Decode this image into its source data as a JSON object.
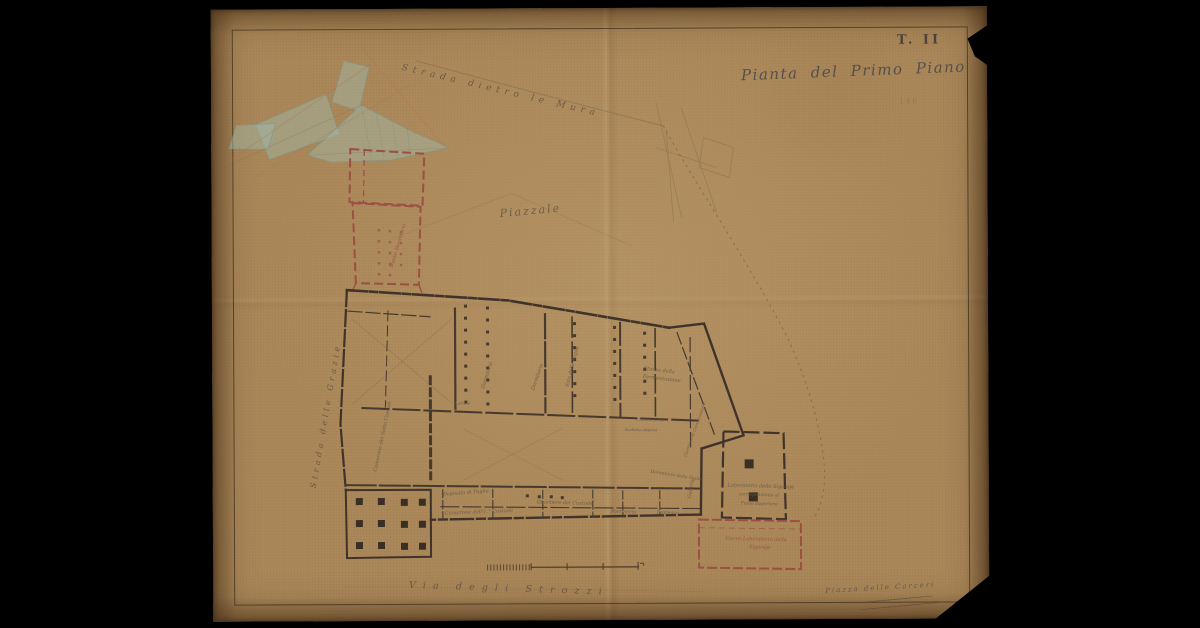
{
  "document": {
    "plate_label": "T. II",
    "title": "Pianta del Primo Piano",
    "stamp_number": "146"
  },
  "streets": {
    "top": "Strada dietro le Mura",
    "left": "Strada delle Grazie",
    "bottom": "Via degli Strozzi",
    "bottom_right": "Piazza delle Carceri"
  },
  "areas": {
    "piazzale": "Piazzale"
  },
  "rooms": [
    {
      "label": "Dormitorio"
    },
    {
      "label": "Dormitorio"
    },
    {
      "label": "Sala delle Veglie"
    },
    {
      "label": "Camerone dei Sotto Custodi"
    },
    {
      "label": "Stanza della"
    },
    {
      "label": "Fermentazione"
    },
    {
      "label": "Quartiere del Custode"
    },
    {
      "label": "Deposito di Paglia"
    },
    {
      "label": "Camerone dell'1.° Custode"
    },
    {
      "label": "Portineria"
    },
    {
      "label": "Ingresso"
    },
    {
      "label": "Dormitorio delle Figlie"
    },
    {
      "label": "Galleria"
    },
    {
      "label": "Laboratorio delle Sigaraje"
    },
    {
      "label": "corrispondente al"
    },
    {
      "label": "Piano Superiore"
    },
    {
      "label": "Nuovo Laboratorio delle"
    },
    {
      "label": "Sigaraje"
    },
    {
      "label": "Nuovo Dormitorio"
    },
    {
      "label": "Camera forte"
    },
    {
      "label": "Corridore di Comunicazione"
    },
    {
      "label": "Latrine"
    },
    {
      "label": "Scaletta interna"
    }
  ],
  "colors": {
    "background": "#000000",
    "paper": "#ab885a",
    "wall_ink": "#3f332a",
    "script_ink": "#56493c",
    "red_ink": "#9c4f43",
    "teal_wash": "#9fb6a6"
  }
}
